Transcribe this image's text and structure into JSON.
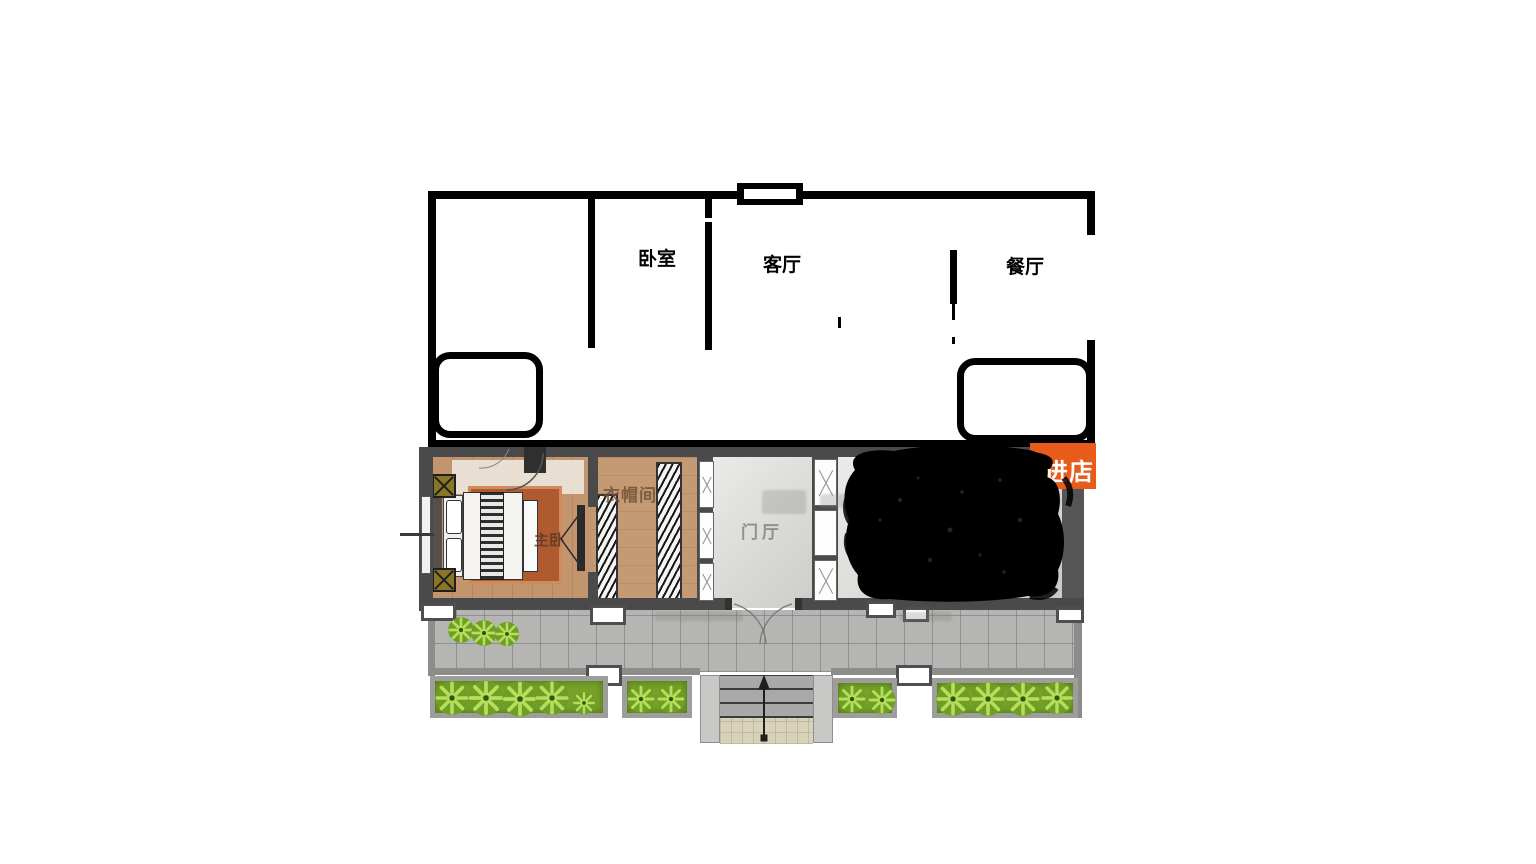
{
  "sketch": {
    "rooms": [
      {
        "id": "bedroom",
        "label": "卧室"
      },
      {
        "id": "living-room",
        "label": "客厅"
      },
      {
        "id": "dining-room",
        "label": "餐厅"
      }
    ]
  },
  "plan": {
    "rooms": [
      {
        "id": "master-bedroom",
        "label": "主卧"
      },
      {
        "id": "cloakroom",
        "label": "衣帽间"
      },
      {
        "id": "entry-hall",
        "label": "门厅"
      }
    ],
    "shop_badge": {
      "label": "进店",
      "color": "#e75c1a"
    }
  },
  "colors": {
    "sketch_line": "#000000",
    "plan_wall": "#4a4a4a",
    "wood_floor": "#c2956f",
    "rug": "#b05a30",
    "hall_floor": "#d8d7d3",
    "terrace_tile": "#b5b5b3",
    "grass": "#76a22b",
    "shrub_light": "#b5df5b",
    "shrub_dark": "#6f9d25",
    "scribble": "#000000",
    "badge_orange": "#e75c1a"
  }
}
